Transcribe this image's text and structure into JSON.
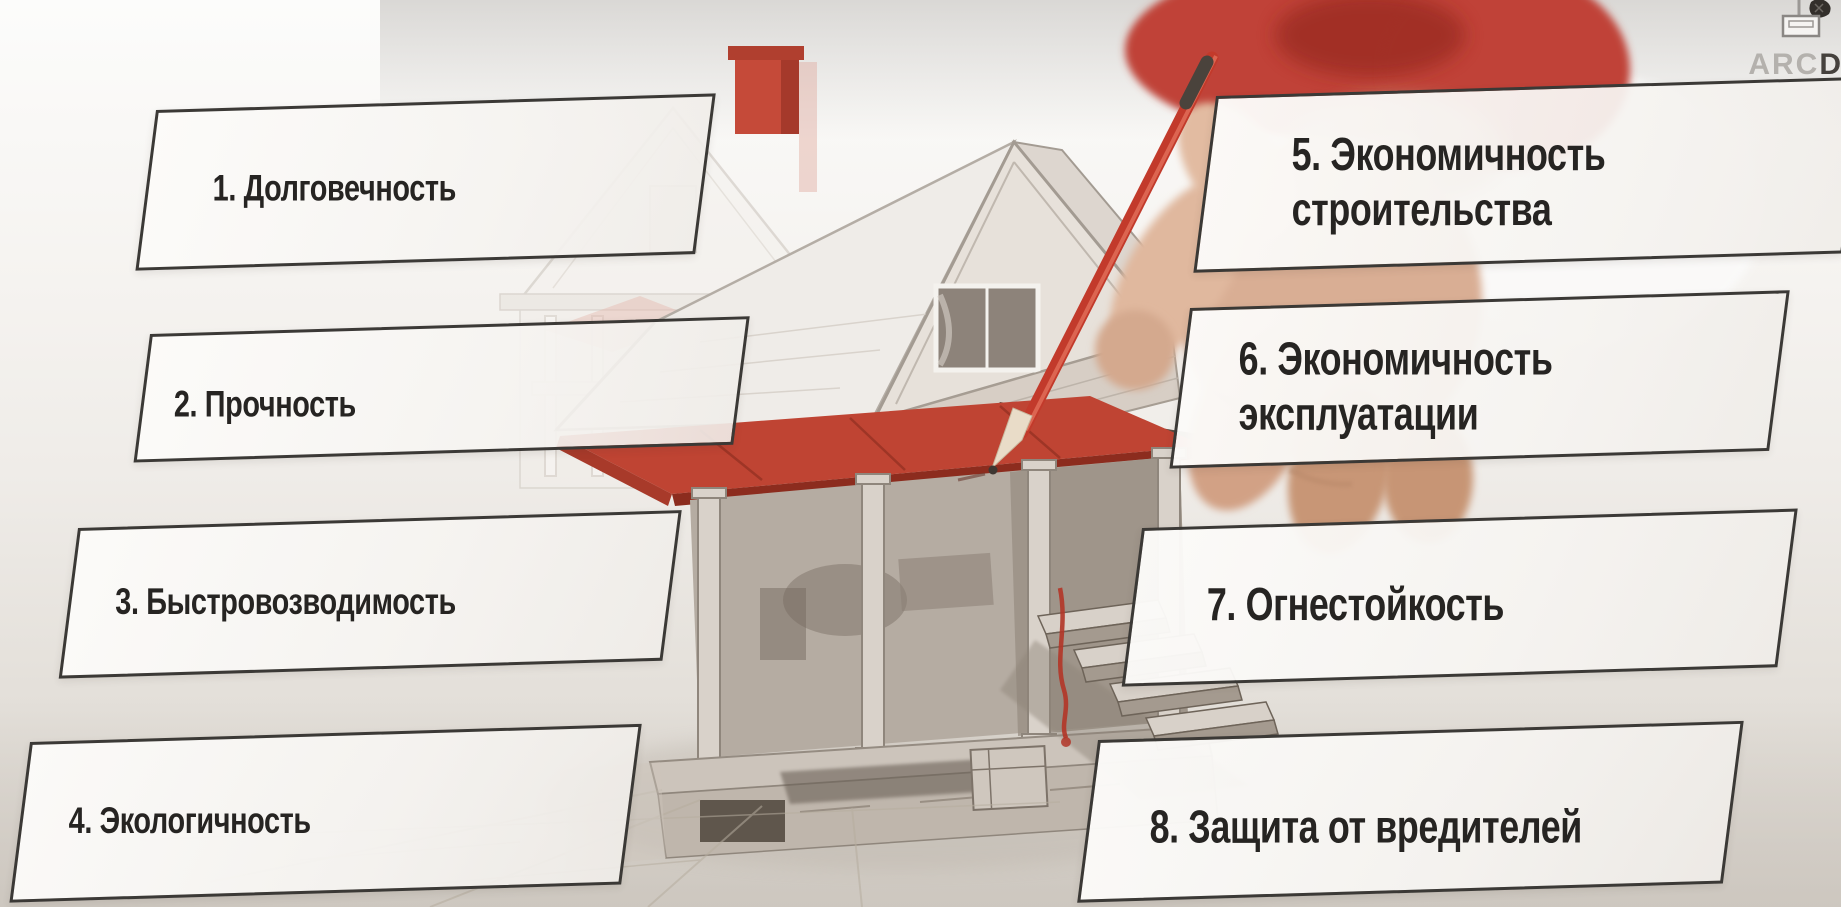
{
  "watermark": {
    "brand_light": "ARC",
    "brand_dark": "D"
  },
  "boxes": {
    "b1": {
      "line1": "1. Долговечность"
    },
    "b2": {
      "line1": "2. Прочность"
    },
    "b3": {
      "line1": "3. Быстровозводимость"
    },
    "b4": {
      "line1": "4. Экологичность"
    },
    "b5": {
      "line1": "5. Экономичность",
      "line2": "строительства"
    },
    "b6": {
      "line1": "6. Экономичность",
      "line2": "эксплуатации"
    },
    "b7": {
      "line1": "7. Огнестойкость"
    },
    "b8": {
      "line1": "8. Защита от вредителей"
    }
  },
  "colors": {
    "accent_red": "#c0392b",
    "roof_red": "#bf4433",
    "chimney_red": "#c54a39",
    "box_border": "#3b3936",
    "box_fill": "#faf9f7",
    "text": "#262422",
    "sketch_line": "#a89f95",
    "skin": "#d9ae94"
  }
}
